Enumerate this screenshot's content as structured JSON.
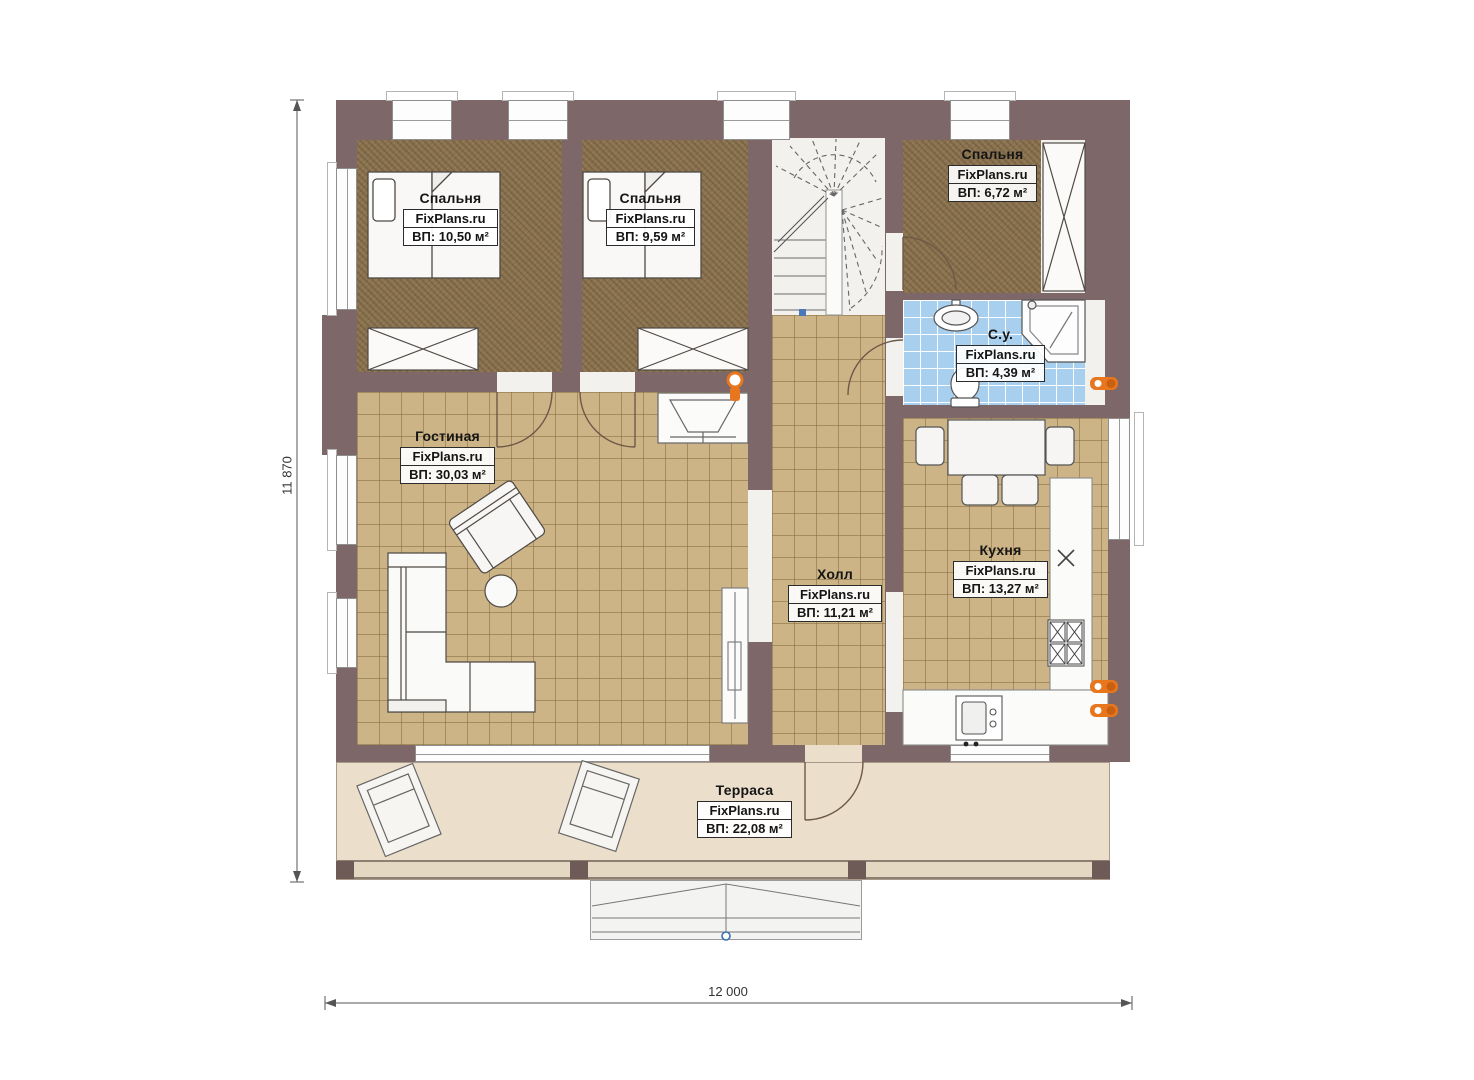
{
  "plan": {
    "brand": "FixPlans.ru",
    "type": "floor-plan-first-floor",
    "rooms": {
      "bedroom1": {
        "name": "Спальня",
        "brand": "FixPlans.ru",
        "area": "ВП: 10,50 м²"
      },
      "bedroom2": {
        "name": "Спальня",
        "brand": "FixPlans.ru",
        "area": "ВП: 9,59 м²"
      },
      "bedroom3": {
        "name": "Спальня",
        "brand": "FixPlans.ru",
        "area": "ВП: 6,72 м²"
      },
      "bathroom": {
        "name": "С.у.",
        "brand": "FixPlans.ru",
        "area": "ВП: 4,39 м²"
      },
      "living": {
        "name": "Гостиная",
        "brand": "FixPlans.ru",
        "area": "ВП: 30,03 м²"
      },
      "hall": {
        "name": "Холл",
        "brand": "FixPlans.ru",
        "area": "ВП: 11,21 м²"
      },
      "kitchen": {
        "name": "Кухня",
        "brand": "FixPlans.ru",
        "area": "ВП: 13,27 м²"
      },
      "terrace": {
        "name": "Терраса",
        "brand": "FixPlans.ru",
        "area": "ВП: 22,08 м²"
      }
    },
    "dimensions": {
      "height_mm": "11 870",
      "width_mm": "12 000"
    },
    "colors": {
      "wall": "#7d6769",
      "bedroom_floor": "#8b7350",
      "tile_floor": "#ccb487",
      "bathroom_floor": "#a9cfee",
      "terrace_floor": "#ebdfcb",
      "radiator_accent": "#e8761e"
    }
  }
}
